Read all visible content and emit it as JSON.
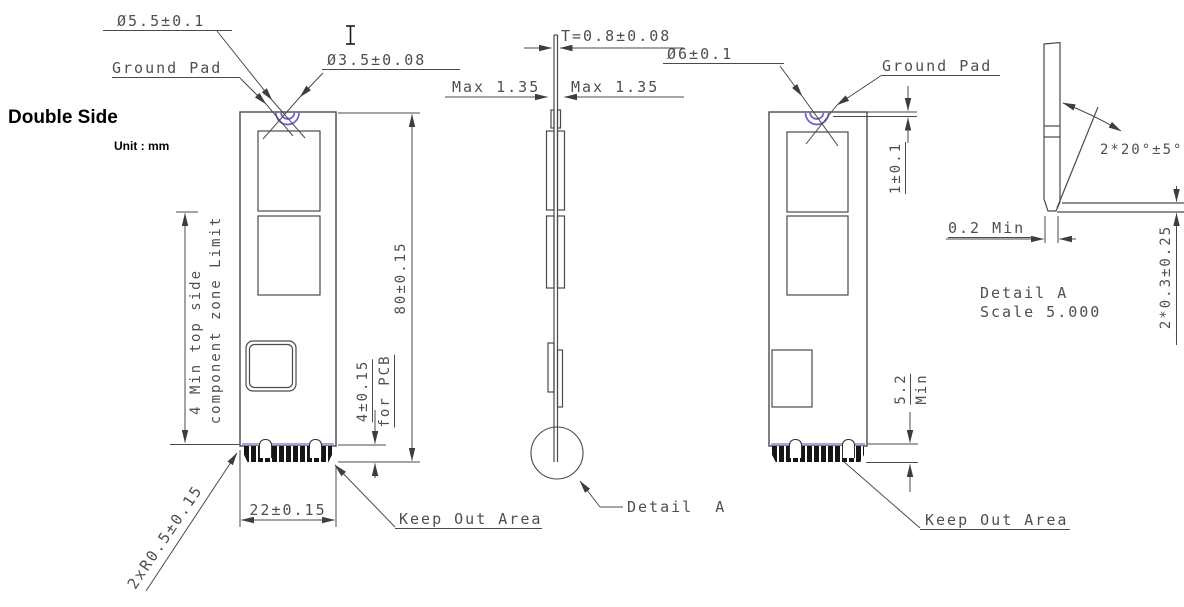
{
  "header": {
    "title": "Double Side",
    "unit": "Unit : mm"
  },
  "front_view": {
    "dia_outer": "Ø5.5±0.1",
    "ground_pad": "Ground Pad",
    "dia_hole": "Ø3.5±0.08",
    "length": "80±0.15",
    "finger_height_l1": "4±0.15",
    "finger_height_l2": "for PCB",
    "zone_l1": "4 Min top side",
    "zone_l2": "component zone Limit",
    "width": "22±0.15",
    "corner_radius": "2xR0.5±0.15",
    "keep_out": "Keep Out Area"
  },
  "side_view": {
    "thickness": "T=0.8±0.08",
    "max_left": "Max 1.35",
    "max_right": "Max 1.35",
    "detail_callout": "Detail  A"
  },
  "back_view": {
    "dia_outer": "Ø6±0.1",
    "ground_pad": "Ground Pad",
    "notch_depth": "1±0.1",
    "clearance_l1": "5.2",
    "clearance_l2": "Min",
    "keep_out": "Keep Out Area"
  },
  "detail_a": {
    "angle": "2*20°±5°",
    "standoff": "0.2 Min",
    "lead_length": "2*0.3±0.25",
    "title": "Detail A",
    "scale": "Scale 5.000"
  },
  "colors": {
    "line": "#4a4a4a",
    "accent_purple": "#6a5fd0",
    "keepout_line": "#8c86dd",
    "finger_black": "#151515"
  }
}
